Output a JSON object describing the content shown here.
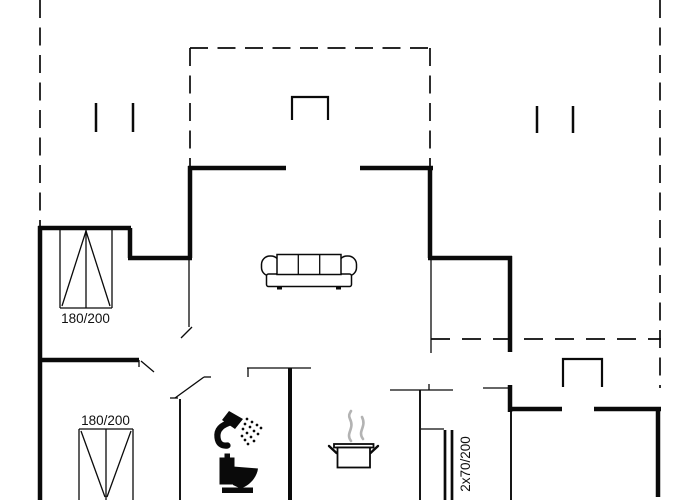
{
  "floorplan": {
    "colors": {
      "line": "#0a0a0a",
      "steam": "#b3b3b3",
      "text": "#111111",
      "background": "#ffffff"
    },
    "labels": {
      "window_top_left": "180/200",
      "window_bottom_left": "180/200",
      "double_door_right": "2x70/200"
    },
    "icons": [
      "sofa-icon",
      "shower-icon",
      "toilet-icon",
      "cooking-pot-icon",
      "chimney-icon-top",
      "chimney-icon-right",
      "roof-post-icon"
    ]
  }
}
